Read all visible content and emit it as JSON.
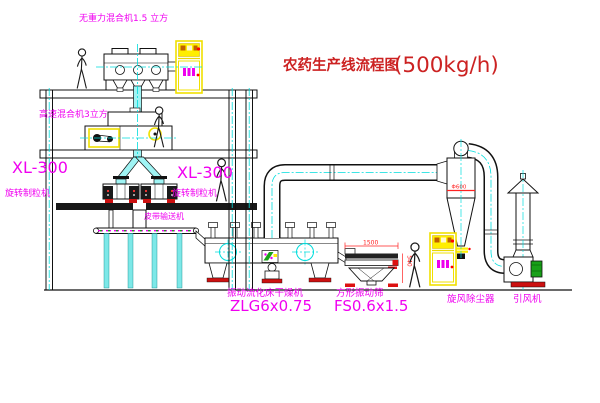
{
  "title": {
    "main": "农药生产线流程图",
    "capacity": "(500kg/h)"
  },
  "labels": {
    "gravity_mixer": "无重力混合机1.5 立方",
    "high_speed_mixer": "高速混合机3立方",
    "granulator_model_left": "XL-300",
    "granulator_name_left": "旋转制粒机",
    "granulator_model_center": "XL-300",
    "granulator_name_center": "旋转制粒机",
    "belt_conveyor": "皮带输送机",
    "dryer_name": "振动流化床干燥机",
    "dryer_model": "ZLG6x0.75",
    "sieve_name": "方形振动筛",
    "sieve_model": "FS0.6x1.5",
    "cyclone": "旋风除尘器",
    "fan": "引风机"
  },
  "dimensions": {
    "sieve_width": "1500",
    "sieve_side": "540",
    "cyclone_note": "Φ600"
  },
  "colors": {
    "label_magenta": "#f000f0",
    "title_red": "#cc2222",
    "centerline_cyan": "#00dddd",
    "cabinet_yellow": "#f0e000",
    "accent_red": "#ff2020",
    "motor_green": "#18a018"
  }
}
